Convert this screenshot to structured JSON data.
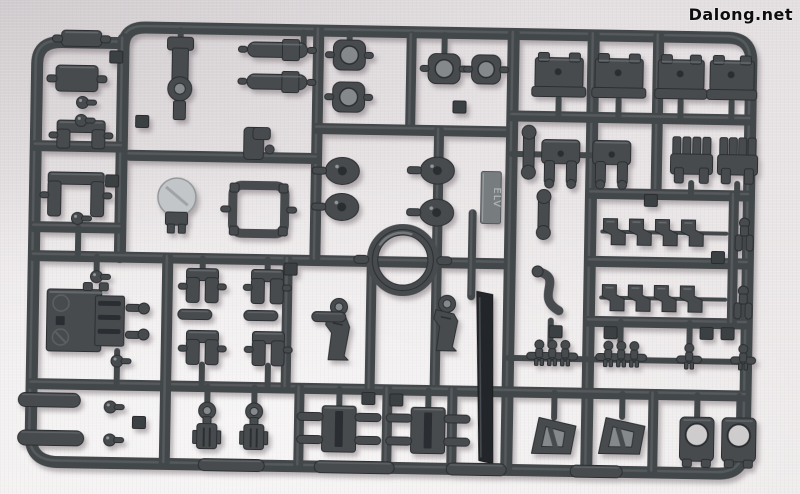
{
  "watermark": {
    "text": "Dalong.net"
  },
  "scene": {
    "subject": "dark gray injection-molded model kit sprue runner with parts, photographed on light fabric",
    "colors": {
      "bg": "#e9e5e6",
      "runner": "#43474a",
      "runnerHi": "#82878a",
      "part": "#474b4e",
      "partDark": "#2b2e30",
      "partHi": "#919699",
      "recess": "#85898c",
      "holeLight": "#cfcccd",
      "blade": "#24272a",
      "dome": "#c2c6c8",
      "plate": "#777b7e",
      "plateText": "#b9bec0",
      "tab": "#3b3f42"
    },
    "tilt_deg": 1.0,
    "mold_mark": {
      "label": "ELV"
    }
  },
  "sprue": {
    "frame_paths": [
      "M 120 52 Q 120 32 142 32 L 724 32 Q 748 32 748 56 L 748 442 Q 748 468 722 468 L 62 468 Q 34 468 34 442 L 34 70 Q 34 48 58 48 L 120 48",
      "M 120 44 L 120 262"
    ],
    "segments": [
      [
        34,
        152,
        120,
        152,
        11
      ],
      [
        34,
        233,
        120,
        233,
        11
      ],
      [
        34,
        262,
        510,
        262,
        11
      ],
      [
        315,
        32,
        315,
        262,
        11
      ],
      [
        408,
        36,
        408,
        130,
        10
      ],
      [
        315,
        130,
        510,
        130,
        11
      ],
      [
        128,
        160,
        315,
        160,
        11
      ],
      [
        437,
        130,
        437,
        390,
        10
      ],
      [
        510,
        32,
        510,
        468,
        12
      ],
      [
        590,
        32,
        590,
        468,
        12
      ],
      [
        655,
        32,
        655,
        190,
        11
      ],
      [
        510,
        114,
        748,
        114,
        11
      ],
      [
        590,
        190,
        748,
        190,
        11
      ],
      [
        590,
        258,
        748,
        258,
        11
      ],
      [
        590,
        318,
        748,
        318,
        11
      ],
      [
        34,
        390,
        748,
        390,
        11
      ],
      [
        733,
        190,
        733,
        318,
        10
      ],
      [
        168,
        262,
        168,
        468,
        11
      ],
      [
        288,
        262,
        288,
        390,
        10
      ],
      [
        372,
        262,
        372,
        390,
        10
      ],
      [
        302,
        390,
        302,
        468,
        10
      ],
      [
        390,
        390,
        390,
        468,
        10
      ],
      [
        455,
        390,
        455,
        468,
        10
      ],
      [
        656,
        390,
        656,
        468,
        10
      ],
      [
        472,
        212,
        472,
        295,
        8
      ],
      [
        510,
        356,
        748,
        356,
        6
      ],
      [
        602,
        228,
        726,
        228,
        4
      ],
      [
        602,
        294,
        726,
        294,
        4
      ]
    ],
    "stubs": [
      [
        177,
        34,
        177,
        52
      ],
      [
        300,
        34,
        300,
        52
      ],
      [
        441,
        34,
        441,
        56
      ],
      [
        346,
        34,
        346,
        45
      ],
      [
        556,
        96,
        556,
        114
      ],
      [
        616,
        96,
        616,
        114
      ],
      [
        678,
        96,
        678,
        114
      ],
      [
        729,
        96,
        729,
        114
      ],
      [
        510,
        152,
        540,
        152
      ],
      [
        578,
        152,
        592,
        152
      ],
      [
        690,
        178,
        690,
        191
      ],
      [
        736,
        178,
        736,
        191
      ],
      [
        203,
        262,
        203,
        273
      ],
      [
        268,
        262,
        268,
        273
      ],
      [
        204,
        368,
        204,
        390
      ],
      [
        270,
        368,
        270,
        390
      ],
      [
        210,
        390,
        210,
        406
      ],
      [
        257,
        390,
        257,
        406
      ],
      [
        342,
        390,
        342,
        408
      ],
      [
        431,
        390,
        431,
        408
      ],
      [
        700,
        390,
        700,
        413
      ],
      [
        742,
        390,
        742,
        413
      ],
      [
        557,
        390,
        557,
        415
      ],
      [
        625,
        390,
        625,
        413
      ],
      [
        552,
        318,
        552,
        343
      ],
      [
        622,
        318,
        622,
        343
      ],
      [
        691,
        318,
        691,
        343
      ],
      [
        97,
        262,
        97,
        277
      ],
      [
        119,
        356,
        119,
        390
      ],
      [
        78,
        233,
        78,
        262
      ]
    ],
    "parts": [
      {
        "t": "lump",
        "x": 78,
        "y": 44,
        "w": 40,
        "h": 16
      },
      {
        "t": "lump",
        "x": 74,
        "y": 84,
        "w": 42,
        "h": 26
      },
      {
        "t": "ubracket",
        "x": 79,
        "y": 140,
        "w": 48,
        "h": 28
      },
      {
        "t": "ubracket",
        "x": 75,
        "y": 200,
        "w": 56,
        "h": 44
      },
      {
        "t": "ballpin",
        "x": 80,
        "y": 108
      },
      {
        "t": "ballpin",
        "x": 79,
        "y": 126
      },
      {
        "t": "ballpin",
        "x": 77,
        "y": 224
      },
      {
        "t": "polering",
        "x": 177,
        "y": 84,
        "w": 26,
        "h": 86
      },
      {
        "t": "cylinder",
        "x": 274,
        "y": 52,
        "w": 60,
        "h": 15
      },
      {
        "t": "cylinder",
        "x": 274,
        "y": 84,
        "w": 60,
        "h": 15
      },
      {
        "t": "ringsq",
        "x": 346,
        "y": 56,
        "w": 32,
        "h": 30
      },
      {
        "t": "ringsq",
        "x": 346,
        "y": 98,
        "w": 32,
        "h": 30
      },
      {
        "t": "ringsq",
        "x": 441,
        "y": 68,
        "w": 32,
        "h": 30
      },
      {
        "t": "ringsq",
        "x": 483,
        "y": 68,
        "w": 29,
        "h": 29
      },
      {
        "t": "foot",
        "x": 556,
        "y": 72,
        "w": 48,
        "h": 44
      },
      {
        "t": "foot",
        "x": 616,
        "y": 72,
        "w": 48,
        "h": 44
      },
      {
        "t": "foot",
        "x": 678,
        "y": 72,
        "w": 46,
        "h": 44
      },
      {
        "t": "foot",
        "x": 729,
        "y": 72,
        "w": 44,
        "h": 44
      },
      {
        "t": "hand",
        "x": 559,
        "y": 160,
        "w": 38,
        "h": 46
      },
      {
        "t": "hand",
        "x": 610,
        "y": 160,
        "w": 38,
        "h": 46
      },
      {
        "t": "claw",
        "x": 690,
        "y": 156,
        "w": 42,
        "h": 48
      },
      {
        "t": "claw",
        "x": 736,
        "y": 156,
        "w": 40,
        "h": 48
      },
      {
        "t": "hook",
        "x": 260,
        "y": 146,
        "w": 36,
        "h": 32
      },
      {
        "t": "dome",
        "x": 176,
        "y": 206,
        "w": 38,
        "h": 46
      },
      {
        "t": "rectframe",
        "x": 258,
        "y": 212,
        "w": 52,
        "h": 48
      },
      {
        "t": "disc",
        "x": 341,
        "y": 172,
        "w": 34,
        "h": 27
      },
      {
        "t": "disc",
        "x": 341,
        "y": 208,
        "w": 34,
        "h": 27
      },
      {
        "t": "disc",
        "x": 436,
        "y": 170,
        "w": 34,
        "h": 27
      },
      {
        "t": "disc",
        "x": 436,
        "y": 212,
        "w": 34,
        "h": 27
      },
      {
        "t": "bigring",
        "x": 403,
        "y": 260,
        "w": 72,
        "h": 72
      },
      {
        "t": "knee",
        "x": 338,
        "y": 330,
        "w": 34,
        "h": 62
      },
      {
        "t": "knee",
        "x": 446,
        "y": 322,
        "w": 30,
        "h": 56
      },
      {
        "t": "plate",
        "x": 490,
        "y": 196,
        "w": 20,
        "h": 52
      },
      {
        "t": "blade",
        "x": 487,
        "y": 376,
        "w": 19,
        "h": 172
      },
      {
        "t": "bigblock",
        "x": 92,
        "y": 326,
        "w": 88,
        "h": 62
      },
      {
        "t": "ubracket",
        "x": 203,
        "y": 289,
        "w": 32,
        "h": 34
      },
      {
        "t": "ubracket",
        "x": 268,
        "y": 289,
        "w": 32,
        "h": 34
      },
      {
        "t": "ubracket",
        "x": 204,
        "y": 351,
        "w": 32,
        "h": 34
      },
      {
        "t": "ubracket",
        "x": 270,
        "y": 351,
        "w": 32,
        "h": 34
      },
      {
        "t": "pill",
        "x": 196,
        "y": 318,
        "w": 34,
        "h": 10
      },
      {
        "t": "pill",
        "x": 262,
        "y": 318,
        "w": 34,
        "h": 10
      },
      {
        "t": "pill",
        "x": 330,
        "y": 318,
        "w": 34,
        "h": 10
      },
      {
        "t": "pill",
        "x": 52,
        "y": 406,
        "w": 62,
        "h": 14
      },
      {
        "t": "pill",
        "x": 54,
        "y": 444,
        "w": 66,
        "h": 15
      },
      {
        "t": "pill",
        "x": 235,
        "y": 468,
        "w": 66,
        "h": 12
      },
      {
        "t": "pill",
        "x": 358,
        "y": 468,
        "w": 80,
        "h": 12
      },
      {
        "t": "pill",
        "x": 480,
        "y": 468,
        "w": 60,
        "h": 12
      },
      {
        "t": "pill",
        "x": 600,
        "y": 468,
        "w": 52,
        "h": 12
      },
      {
        "t": "ballpin",
        "x": 113,
        "y": 412
      },
      {
        "t": "ballpin",
        "x": 113,
        "y": 445
      },
      {
        "t": "ballpin",
        "x": 97,
        "y": 282
      },
      {
        "t": "ballpin",
        "x": 119,
        "y": 366
      },
      {
        "t": "ringcyl",
        "x": 210,
        "y": 432,
        "w": 26,
        "h": 52
      },
      {
        "t": "ringcyl",
        "x": 257,
        "y": 432,
        "w": 26,
        "h": 52
      },
      {
        "t": "grooveblock",
        "x": 342,
        "y": 430,
        "w": 34,
        "h": 46
      },
      {
        "t": "grooveblock",
        "x": 431,
        "y": 430,
        "w": 34,
        "h": 46
      },
      {
        "t": "triframe",
        "x": 557,
        "y": 433,
        "w": 44,
        "h": 36
      },
      {
        "t": "triframe",
        "x": 625,
        "y": 432,
        "w": 46,
        "h": 36
      },
      {
        "t": "sqhole",
        "x": 700,
        "y": 434,
        "w": 34,
        "h": 44
      },
      {
        "t": "sqhole",
        "x": 742,
        "y": 434,
        "w": 34,
        "h": 44
      },
      {
        "t": "pincluster",
        "x": 554,
        "y": 352,
        "n": 3
      },
      {
        "t": "pincluster",
        "x": 623,
        "y": 352,
        "n": 3
      },
      {
        "t": "pincluster",
        "x": 691,
        "y": 353,
        "n": 1
      },
      {
        "t": "pincluster",
        "x": 745,
        "y": 353,
        "n": 1
      },
      {
        "t": "zpart",
        "x": 614,
        "y": 228
      },
      {
        "t": "zpart",
        "x": 640,
        "y": 228
      },
      {
        "t": "zpart",
        "x": 666,
        "y": 228
      },
      {
        "t": "zpart",
        "x": 692,
        "y": 228
      },
      {
        "t": "zpart",
        "x": 614,
        "y": 294
      },
      {
        "t": "zpart",
        "x": 640,
        "y": 294
      },
      {
        "t": "zpart",
        "x": 666,
        "y": 294
      },
      {
        "t": "zpart",
        "x": 692,
        "y": 294
      },
      {
        "t": "fork2",
        "x": 744,
        "y": 230
      },
      {
        "t": "fork2",
        "x": 744,
        "y": 298
      },
      {
        "t": "bone",
        "x": 527,
        "y": 150,
        "h": 50
      },
      {
        "t": "bone",
        "x": 543,
        "y": 212,
        "h": 46
      },
      {
        "t": "scurve",
        "x": 551,
        "y": 288
      },
      {
        "t": "tab",
        "x": 113,
        "y": 62
      },
      {
        "t": "tab",
        "x": 111,
        "y": 186
      },
      {
        "t": "tab",
        "x": 140,
        "y": 126
      },
      {
        "t": "tab",
        "x": 291,
        "y": 271
      },
      {
        "t": "tab",
        "x": 371,
        "y": 399
      },
      {
        "t": "tab",
        "x": 399,
        "y": 400
      },
      {
        "t": "tab",
        "x": 457,
        "y": 106
      },
      {
        "t": "tab",
        "x": 557,
        "y": 329
      },
      {
        "t": "tab",
        "x": 612,
        "y": 329
      },
      {
        "t": "tab",
        "x": 708,
        "y": 328
      },
      {
        "t": "tab",
        "x": 729,
        "y": 328
      },
      {
        "t": "tab",
        "x": 718,
        "y": 252
      },
      {
        "t": "tab",
        "x": 650,
        "y": 196
      },
      {
        "t": "tab",
        "x": 142,
        "y": 427
      }
    ]
  }
}
